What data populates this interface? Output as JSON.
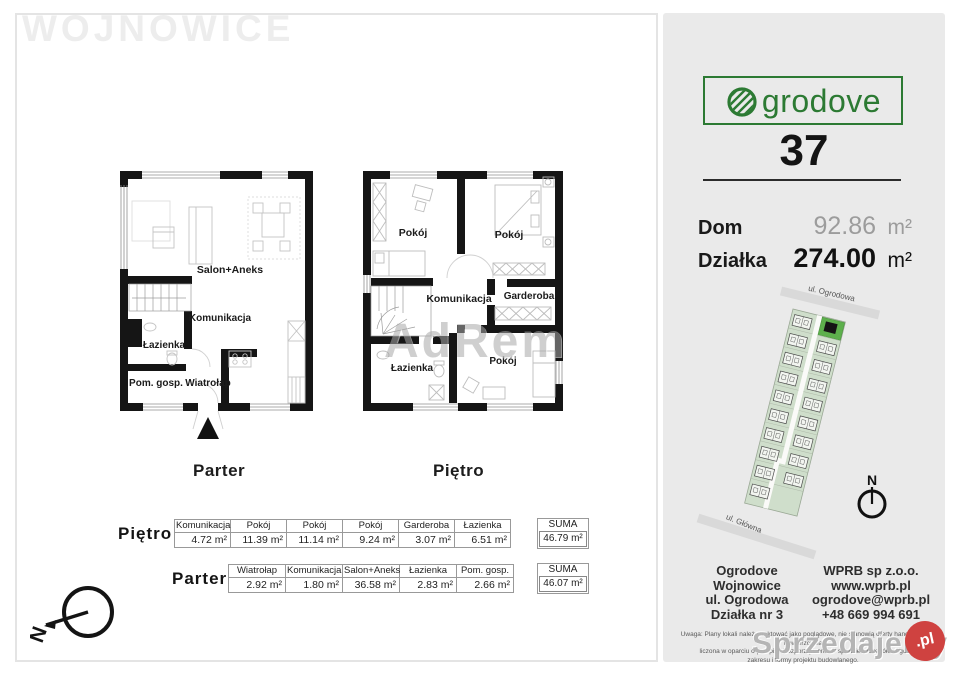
{
  "watermarks": {
    "location": "WOJNOWICE",
    "adrem": "AdRem",
    "sprzedajemy": "Sprzedajemy",
    "pl_badge": ".pl"
  },
  "compass": {
    "main": "N",
    "siteplan": "N"
  },
  "plans": {
    "parter": {
      "caption": "Parter",
      "rooms": {
        "salon": "Salon+Aneks",
        "komunikacja": "Komunikacja",
        "lazienka": "Łazienka",
        "pom_gosp": "Pom. gosp.",
        "wiatrolap": "Wiatrołap"
      }
    },
    "pietro": {
      "caption": "Piętro",
      "rooms": {
        "pokoj1": "Pokój",
        "pokoj2": "Pokój",
        "komunikacja": "Komunikacja",
        "garderoba": "Garderoba",
        "lazienka": "Łazienka",
        "pokoj3": "Pokój"
      }
    }
  },
  "tables": {
    "pietro": {
      "label": "Piętro",
      "cells": [
        {
          "name": "Komunikacja",
          "area": "4.72 m²"
        },
        {
          "name": "Pokój",
          "area": "11.39 m²"
        },
        {
          "name": "Pokój",
          "area": "11.14 m²"
        },
        {
          "name": "Pokój",
          "area": "9.24 m²"
        },
        {
          "name": "Garderoba",
          "area": "3.07 m²"
        },
        {
          "name": "Łazienka",
          "area": "6.51 m²"
        }
      ],
      "suma_label": "SUMA",
      "suma_value": "46.79 m²"
    },
    "parter": {
      "label": "Parter",
      "cells": [
        {
          "name": "Wiatrołap",
          "area": "2.92 m²"
        },
        {
          "name": "Komunikacja",
          "area": "1.80 m²"
        },
        {
          "name": "Salon+Aneks",
          "area": "36.58 m²"
        },
        {
          "name": "Łazienka",
          "area": "2.83 m²"
        },
        {
          "name": "Pom. gosp.",
          "area": "2.66 m²"
        }
      ],
      "suma_label": "SUMA",
      "suma_value": "46.07 m²"
    }
  },
  "sidebar": {
    "brand": "Ogrodove",
    "brand_text": "grodove",
    "unit_number": "37",
    "area_rows": [
      {
        "label": "Dom",
        "value": "92.86",
        "unit": "m²"
      },
      {
        "label": "Działka",
        "value": "274.00",
        "unit": "m²"
      }
    ],
    "siteplan": {
      "street_top": "ul. Ogrodowa",
      "street_bottom": "ul. Główna"
    },
    "contact_left": [
      "Ogrodove",
      "Wojnowice",
      "ul. Ogrodowa",
      "Działka nr 3"
    ],
    "contact_right": [
      "WPRB sp z.o.o.",
      "www.wprb.pl",
      "ogrodove@wprb.pl",
      "+48 669 994 691"
    ],
    "disclaimer_lines": [
      "Uwaga: Plany lokali należy traktować jako poglądowe, nie stanowią oferty handlowej. Powierzchnia",
      "liczona w oparciu o przepisy Rozporządzenia w sprawie szczegółowego",
      "zakresu i formy projektu budowlanego."
    ]
  },
  "colors": {
    "brand_green": "#2c7a33",
    "siteplan_fill": "#cfdecb",
    "highlight_green": "#5db04c",
    "badge_red": "#cf4240"
  }
}
